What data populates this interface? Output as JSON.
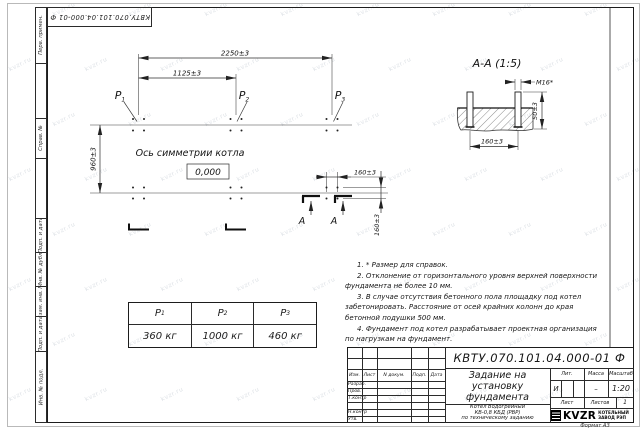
{
  "watermark": "kvzr.ru",
  "frame": {
    "doc_number_top": "КВТУ.070.101.04.000-01 Ф",
    "top_labels": [
      "Перв. примен.",
      "Справ. №"
    ],
    "bottom_labels": [
      "Подп. и дата",
      "Инв. № дубл.",
      "Взам. инв. №",
      "Подп. и дата",
      "Инв. № подл."
    ],
    "format_note": "Формат А3"
  },
  "plan": {
    "dim_total": "2250±3",
    "dim_half": "1125±3",
    "dim_depth": "960±3",
    "dim_bolt_x": "160±3",
    "dim_bolt_y": "160±3",
    "p_labels": [
      {
        "base": "P",
        "sub": "1"
      },
      {
        "base": "P",
        "sub": "2"
      },
      {
        "base": "P",
        "sub": "3"
      }
    ],
    "axis_label": "Ось симметрии котла",
    "elevation_mark": "0,000",
    "section_letter": "А"
  },
  "section_view": {
    "title": "А-А (1:5)",
    "thread": "М16*",
    "dim_height": "50±3",
    "dim_spacing": "160±3"
  },
  "loads_table": {
    "headers": [
      {
        "base": "P",
        "sub": "1"
      },
      {
        "base": "P",
        "sub": "2"
      },
      {
        "base": "P",
        "sub": "3"
      }
    ],
    "values": [
      "360 кг",
      "1000 кг",
      "460 кг"
    ]
  },
  "notes": [
    "1. * Размер для справок.",
    "2. Отклонение от горизонтального уровня верхней поверхности фундамента не более 10 мм.",
    "3. В случае отсутствия бетонного пола площадку под котел забетонировать. Расстояние от осей крайних колонн до края бетонной подушки 500 мм.",
    "4. Фундамент под котел разрабатывает проектная организация по нагрузкам на фундамент."
  ],
  "title_block": {
    "doc_number": "КВТУ.070.101.04.000-01 Ф",
    "title_lines": [
      "Задание на",
      "установку",
      "фундамента"
    ],
    "subtitle_lines": [
      "Котел Водогрейный",
      "КВ-0,8 КБД (РВР)",
      "по техническому заданию"
    ],
    "header_cols": [
      "Изм.",
      "Лист",
      "N докум.",
      "Подп.",
      "Дата"
    ],
    "signature_rows": [
      "Разраб.",
      "Пров.",
      "Т.контр",
      "Н.контр",
      "Утв."
    ],
    "lit_label": "Лит.",
    "lit_value": "И",
    "mass_label": "Масса",
    "mass_value": "–",
    "scale_label": "Масштаб",
    "scale_value": "1:20",
    "sheet_label": "Лист",
    "sheets_label": "Листов",
    "sheets_value": "1",
    "logo_text": "KVZR",
    "company_lines": [
      "КОТЕЛЬНЫЙ",
      "ЗАВОД РЭП"
    ]
  }
}
